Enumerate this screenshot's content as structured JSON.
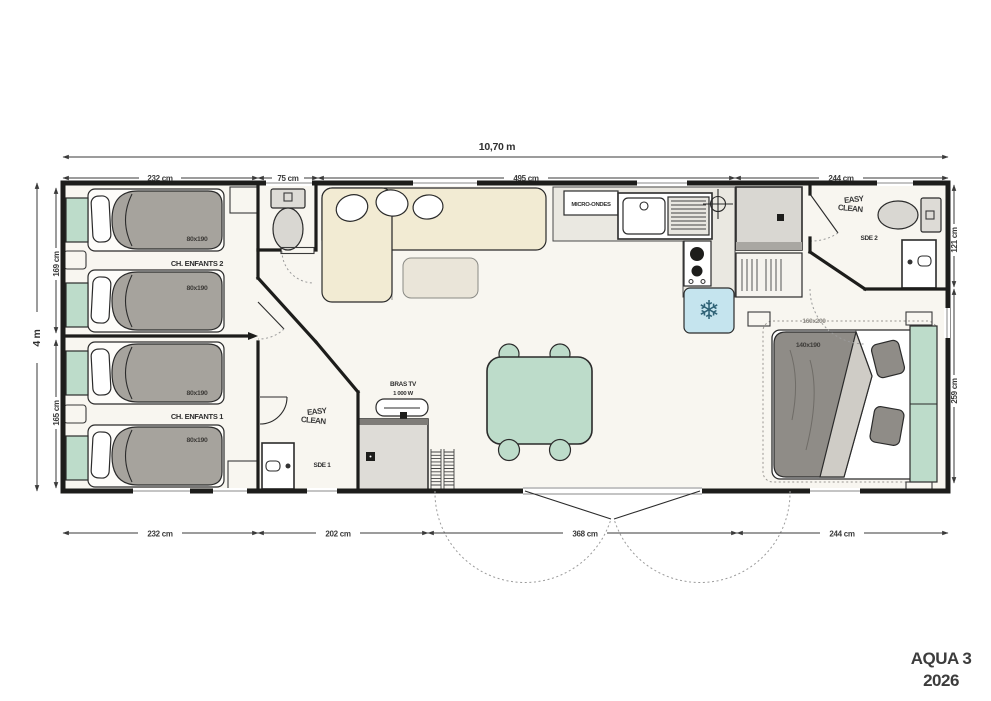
{
  "plan": {
    "brand": {
      "model": "AQUA 3",
      "year": "2026"
    },
    "dims": {
      "overall_width": "10,70 m",
      "overall_depth": "4 m",
      "top": [
        "232 cm",
        "75 cm",
        "495 cm",
        "244 cm"
      ],
      "bottom": [
        "232 cm",
        "202 cm",
        "368 cm",
        "244 cm"
      ],
      "left": [
        "169 cm",
        "165 cm"
      ],
      "right": [
        "121 cm",
        "259 cm"
      ]
    },
    "logo": {
      "line1": "EASY",
      "line2": "CLEAN"
    },
    "rooms": {
      "kids2": {
        "name": "CH. ENFANTS 2",
        "bed1": "80x190",
        "bed2": "80x190"
      },
      "kids1": {
        "name": "CH. ENFANTS 1",
        "bed1": "80x190",
        "bed2": "80x190"
      },
      "shower1": {
        "name": "SDE 1"
      },
      "shower2": {
        "name": "SDE 2"
      },
      "master": {
        "bed": "140x190",
        "bed_zone": "160x200"
      },
      "kitchen": {
        "microwave": "MICRO-ONDES"
      },
      "living": {
        "tv_bracket": "BRAS TV",
        "tv_power": "1 000 W"
      }
    },
    "icons": {
      "fridge": "❄"
    },
    "colors": {
      "wall": "#1d1d1b",
      "mint": "#bddcca",
      "duvet": "#a6a39d",
      "fridge_blue": "#c5e4ee",
      "beige": "#f2ebd3",
      "text": "#3a3a3a"
    }
  }
}
